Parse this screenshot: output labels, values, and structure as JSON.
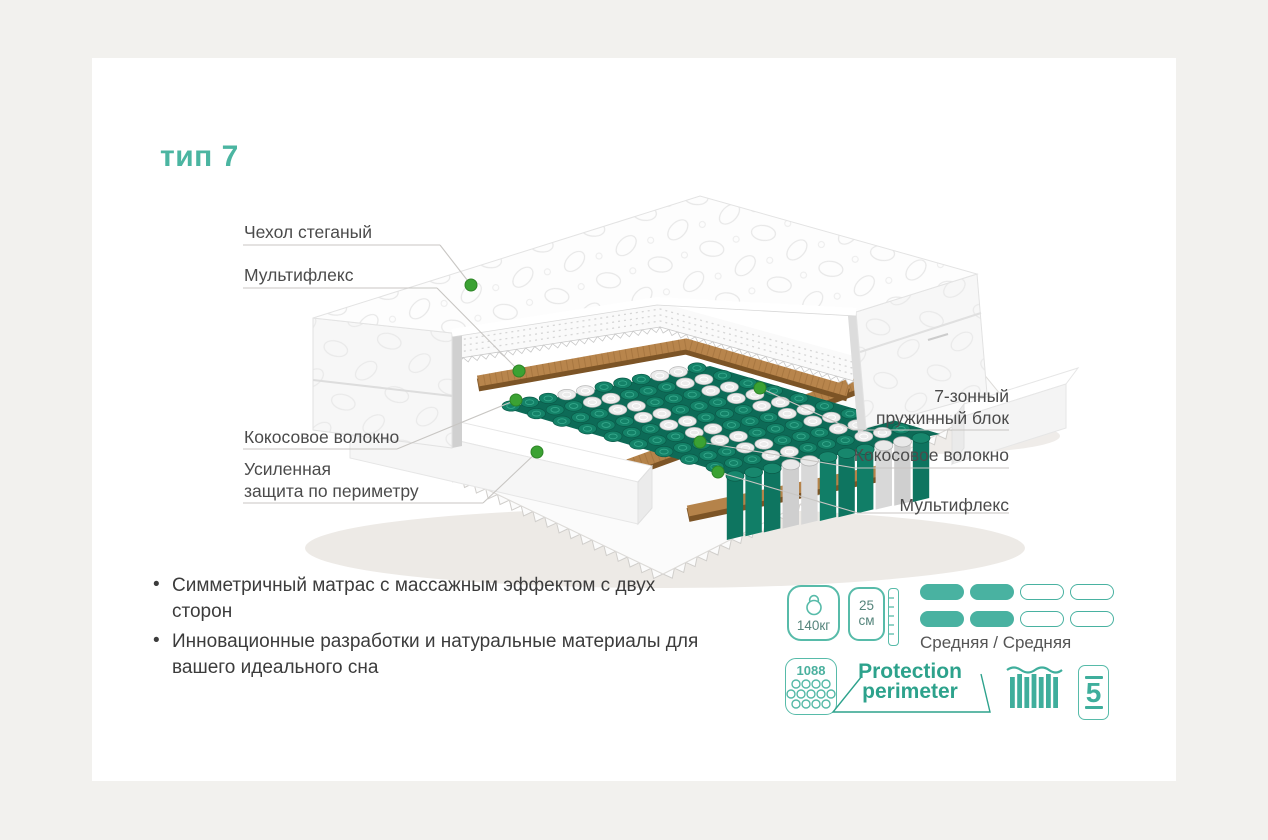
{
  "title": "тип 7",
  "colors": {
    "accent": "#4bb5a1",
    "spring_teal": "#148268",
    "coconut": "#b5834a",
    "dot_green": "#3ba233",
    "label_text": "#4b4b4b"
  },
  "diagram": {
    "labels_left": [
      {
        "line1": "Чехол стеганый"
      },
      {
        "line1": "Мультифлекс"
      },
      {
        "line1": "Кокосовое волокно"
      },
      {
        "line1": "Усиленная",
        "line2": "защита по периметру"
      }
    ],
    "labels_right": [
      {
        "line1": "7-зонный",
        "line2": "пружинный блок"
      },
      {
        "line1": "Кокосовое волокно"
      },
      {
        "line1": "Мультифлекс"
      }
    ]
  },
  "features": [
    "Симметричный матрас с массажным эффектом с двух сторон",
    "Инновационные разработки и натуральные материалы для вашего идеального сна"
  ],
  "specs": {
    "max_weight": "140кг",
    "height_value": "25",
    "height_unit": "см",
    "firmness": "Средняя / Средняя",
    "firmness_filled": 2,
    "firmness_total": 4,
    "spring_count": "1088",
    "protection_line1": "Protection",
    "protection_line2": "perimeter",
    "zone_bars": 7,
    "warranty_years": "5"
  },
  "icons": {
    "weight": "kettlebell-icon",
    "height": "ruler-icon",
    "springs": "spring-grid-icon",
    "zones": "zones-bars-icon",
    "warranty": "mattress-5-icon"
  }
}
